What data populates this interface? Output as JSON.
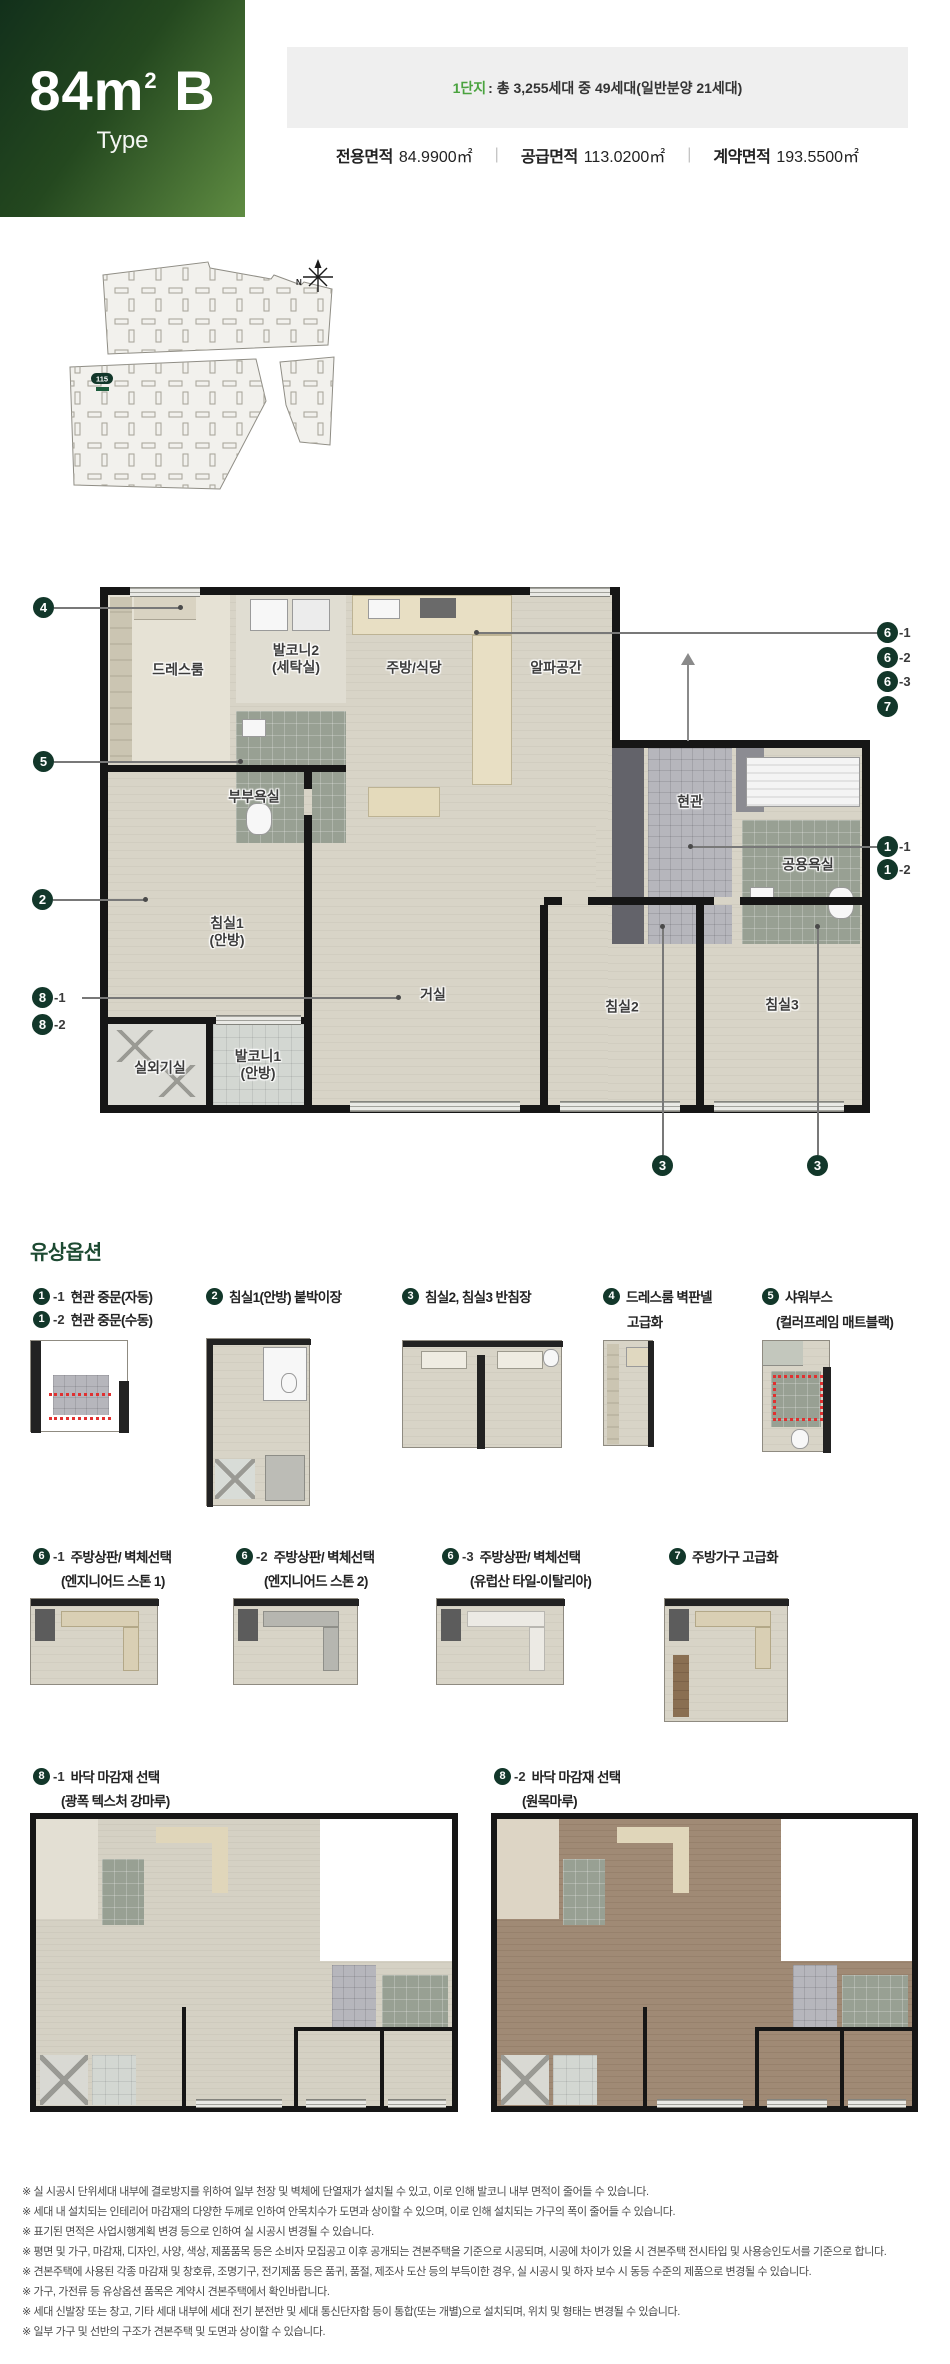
{
  "colors": {
    "accent_dark_green": "#12372a",
    "title_green": "#1d4a32",
    "complex_green": "#4aa33f",
    "floor_light": "#d6d2c5",
    "floor_wood_brown": "#9c8672"
  },
  "header": {
    "size": "84",
    "size_unit": "m",
    "size_sup": "2",
    "type_letter": " B",
    "type_label": "Type",
    "complex_highlight": "1단지",
    "complex_info": ": 총 3,255세대 중 49세대(일반분양 21세대)",
    "separator": "|",
    "areas": [
      {
        "label": "전용면적",
        "value": "84.9900㎡"
      },
      {
        "label": "공급면적",
        "value": "113.0200㎡"
      },
      {
        "label": "계약면적",
        "value": "193.5500㎡"
      }
    ]
  },
  "site_plan": {
    "building_badge": "115",
    "north_label": "N"
  },
  "floor_plan": {
    "rooms": {
      "dress": {
        "l1": "드레스룸"
      },
      "balcony2": {
        "l1": "발코니2",
        "l2": "(세탁실)"
      },
      "kitchen": {
        "l1": "주방/식당"
      },
      "alpha": {
        "l1": "알파공간"
      },
      "master_bath": {
        "l1": "부부욕실"
      },
      "entry": {
        "l1": "현관"
      },
      "common_bath": {
        "l1": "공용욕실"
      },
      "bed1": {
        "l1": "침실1",
        "l2": "(안방)"
      },
      "living": {
        "l1": "거실"
      },
      "bed2": {
        "l1": "침실2"
      },
      "bed3": {
        "l1": "침실3"
      },
      "ac_room": {
        "l1": "실외기실"
      },
      "balcony1": {
        "l1": "발코니1",
        "l2": "(안방)"
      }
    },
    "markers": {
      "m4": "4",
      "m5": "5",
      "m2": "2",
      "m8a_n": "8",
      "m8a_s": "-1",
      "m8b_n": "8",
      "m8b_s": "-2",
      "m6a_n": "6",
      "m6a_s": "-1",
      "m6b_n": "6",
      "m6b_s": "-2",
      "m6c_n": "6",
      "m6c_s": "-3",
      "m7": "7",
      "m1a_n": "1",
      "m1a_s": "-1",
      "m1b_n": "1",
      "m1b_s": "-2",
      "m3a": "3",
      "m3b": "3"
    }
  },
  "options": {
    "title": "유상옵션",
    "row1": [
      {
        "line1": {
          "num": "1",
          "sfx": "-1",
          "label": "현관 중문(자동)"
        },
        "line2": {
          "num": "1",
          "sfx": "-2",
          "label": "현관 중문(수동)"
        }
      },
      {
        "line1": {
          "num": "2",
          "label": "침실1(안방) 붙박이장"
        }
      },
      {
        "line1": {
          "num": "3",
          "label": "침실2, 침실3 반침장"
        }
      },
      {
        "line1": {
          "num": "4",
          "label": "드레스룸 벽판넬"
        },
        "line2_text": "고급화"
      },
      {
        "line1": {
          "num": "5",
          "label": "샤워부스"
        },
        "line2_text": "(컬러프레임 매트블랙)"
      }
    ],
    "row2": [
      {
        "num": "6",
        "sfx": "-1",
        "label": "주방상판/ 벽체선택",
        "label2": "(엔지니어드 스톤 1)"
      },
      {
        "num": "6",
        "sfx": "-2",
        "label": "주방상판/ 벽체선택",
        "label2": "(엔지니어드 스톤 2)"
      },
      {
        "num": "6",
        "sfx": "-3",
        "label": "주방상판/ 벽체선택",
        "label2": "(유럽산 타일-이탈리아)"
      },
      {
        "num": "7",
        "label": "주방가구 고급화"
      }
    ],
    "row3": [
      {
        "num": "8",
        "sfx": "-1",
        "label": "바닥 마감재 선택",
        "label2": "(광폭 텍스처 강마루)"
      },
      {
        "num": "8",
        "sfx": "-2",
        "label": "바닥 마감재 선택",
        "label2": "(원목마루)"
      }
    ]
  },
  "footnotes": [
    "※ 실 시공시 단위세대 내부에 결로방지를 위하여 일부 천장 및 벽체에 단열재가 설치될 수 있고, 이로 인해 발코니 내부 면적이 줄어들 수 있습니다.",
    "※ 세대 내 설치되는 인테리어 마감재의 다양한 두께로 인하여 안목치수가 도면과 상이할 수 있으며, 이로 인해 설치되는 가구의 폭이 줄어들 수 있습니다.",
    "※ 표기된 면적은 사업시행계획 변경 등으로 인하여 실 시공시 변경될 수 있습니다.",
    "※ 평면 및 가구, 마감재, 디자인, 사양, 색상, 제품품목 등은 소비자 모집공고 이후 공개되는 견본주택을 기준으로 시공되며, 시공에 차이가 있을 시 견본주택 전시타입 및 사용승인도서를 기준으로 합니다.",
    "※ 견본주택에 사용된 각종 마감재 및 창호류, 조명기구, 전기제품 등은 품귀, 품절, 제조사 도산 등의 부득이한 경우, 실 시공시 및 하자 보수 시 동등 수준의 제품으로 변경될 수 있습니다.",
    "※ 가구, 가전류 등 유상옵션 품목은 계약시 견본주택에서 확인바랍니다.",
    "※ 세대 신발장 또는 창고, 기타 세대 내부에 세대 전기 분전반 및 세대 통신단자함 등이 통합(또는 개별)으로 설치되며, 위치 및 형태는 변경될 수 있습니다.",
    "※ 일부 가구 및 선반의 구조가 견본주택 및 도면과 상이할 수 있습니다."
  ]
}
